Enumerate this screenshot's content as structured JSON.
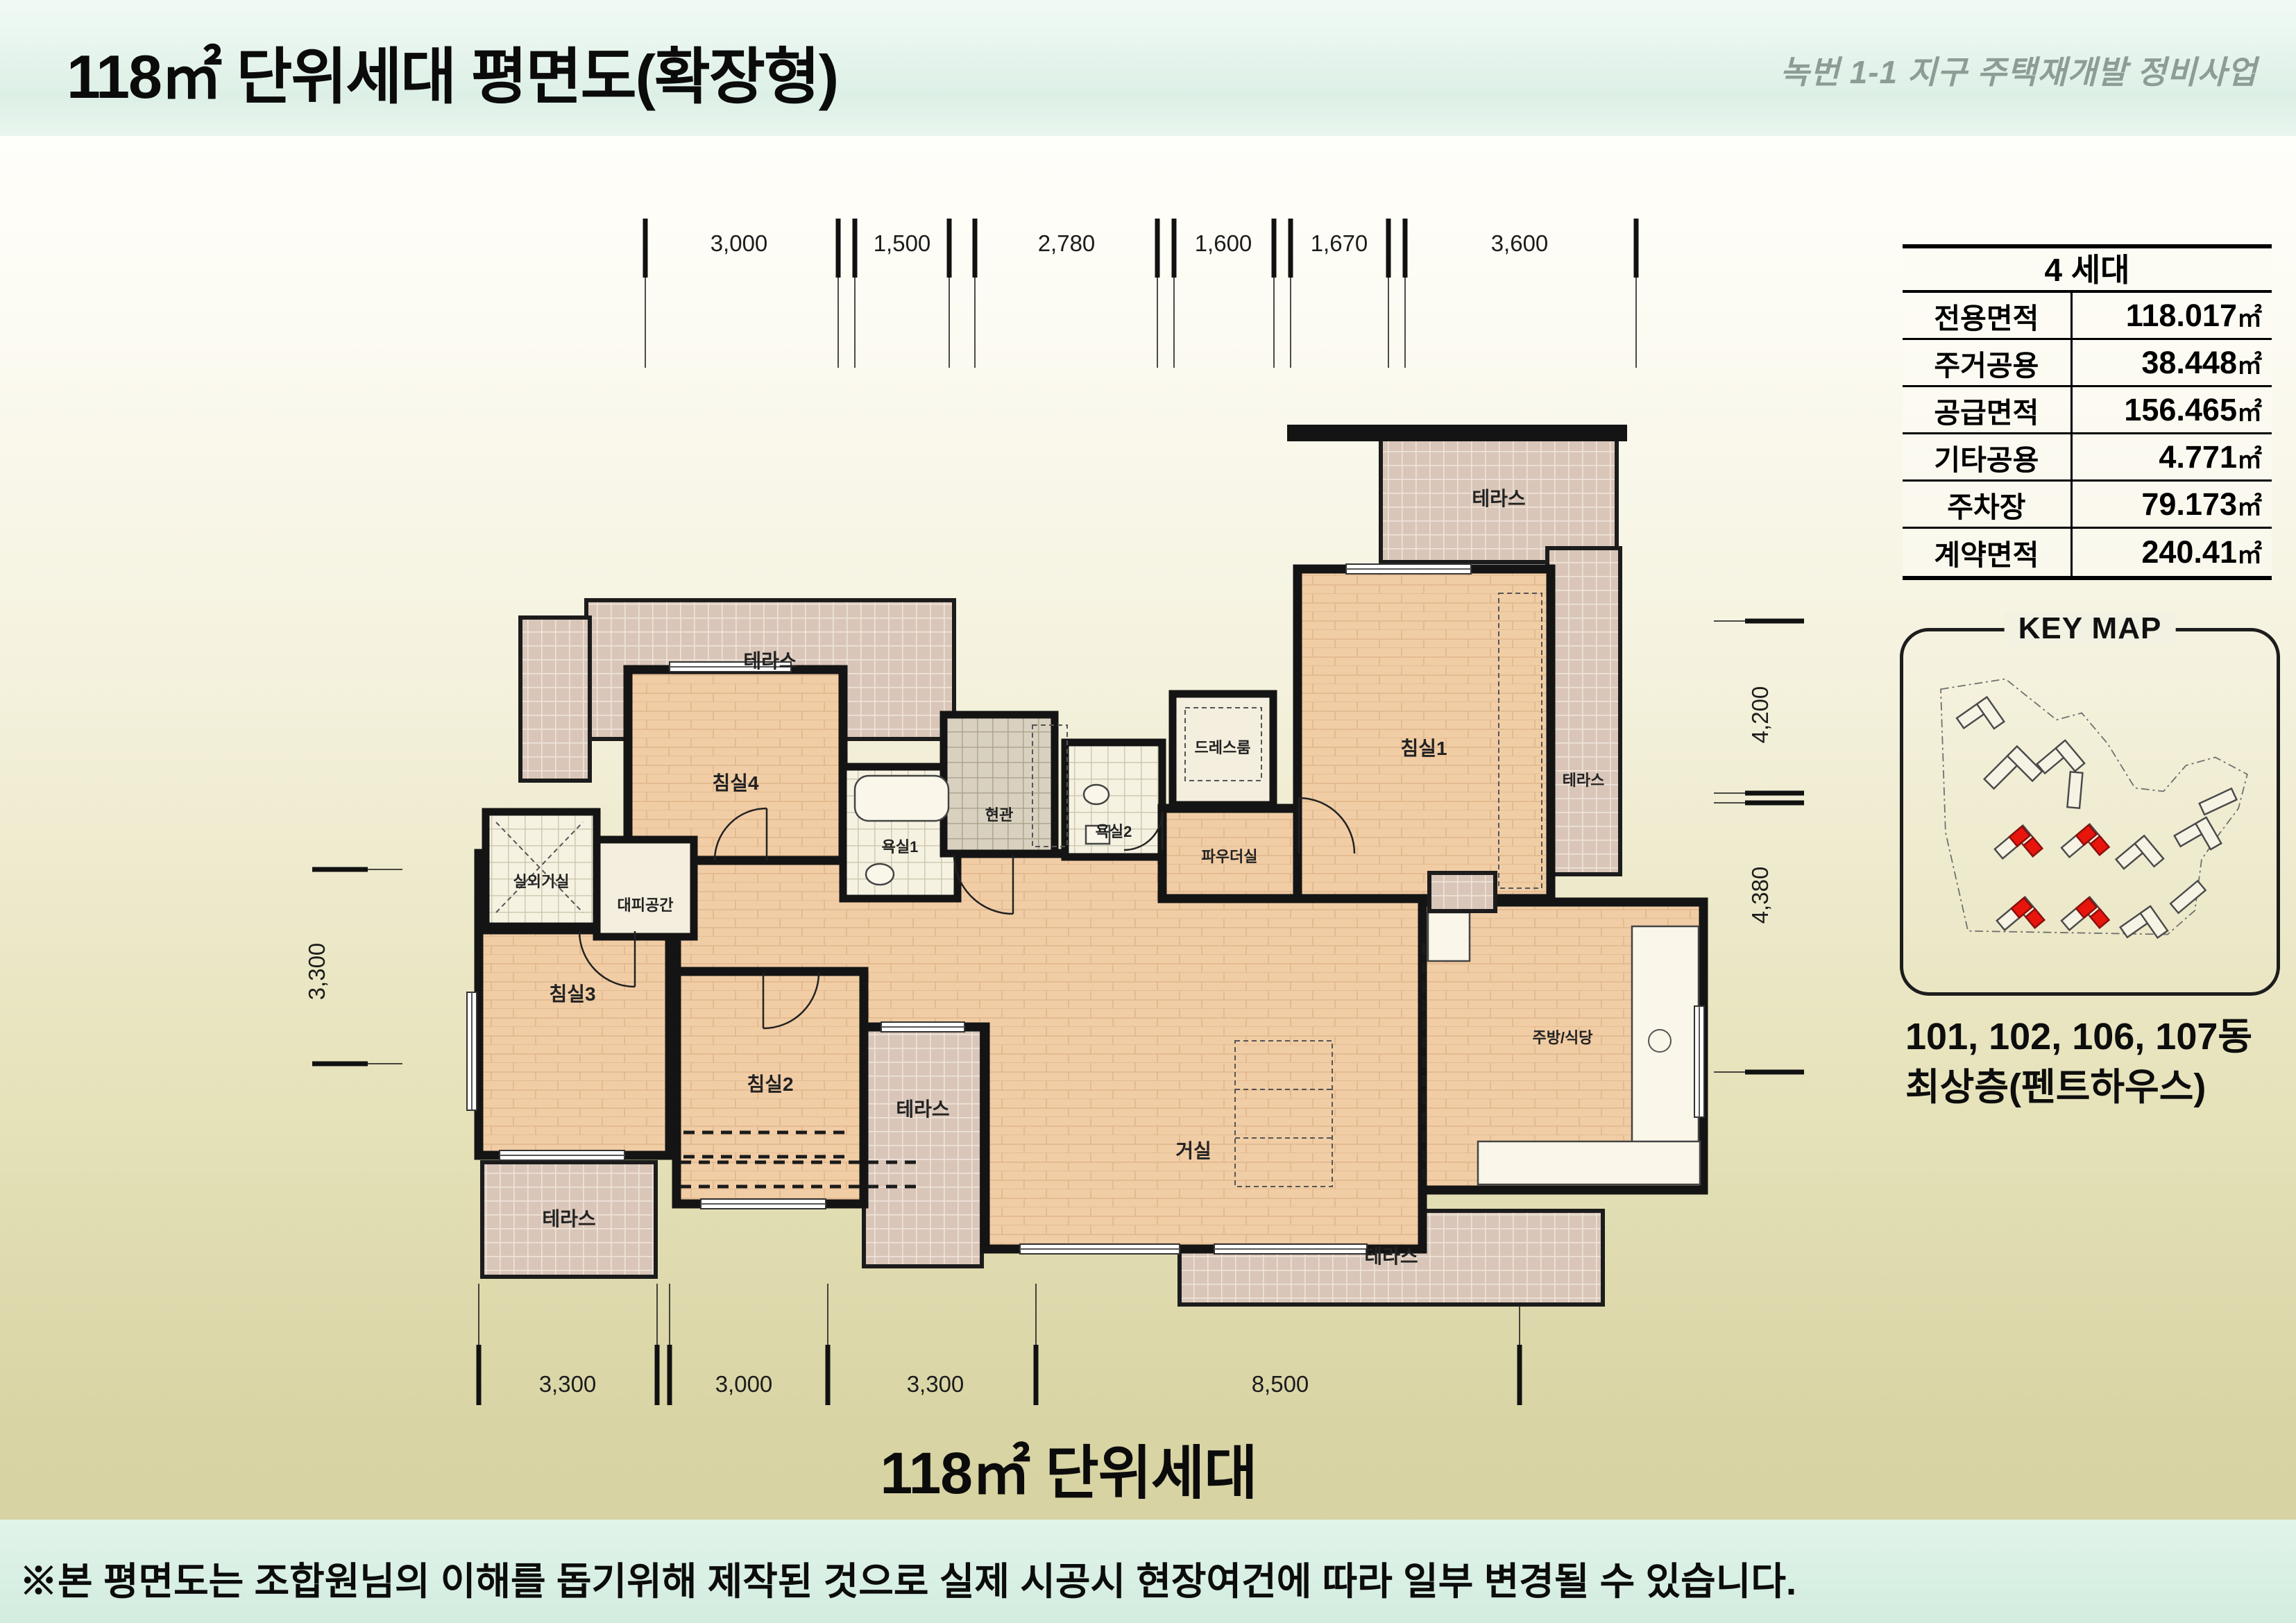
{
  "page": {
    "title": "118㎡ 단위세대 평면도(확장형)",
    "project": "녹번 1-1 지구 주택재개발 정비사업",
    "bottom_title": "118㎡ 단위세대",
    "footnote": "※본 평면도는 조합원님의 이해를 돕기위해 제작된 것으로 실제 시공시 현장여건에 따라 일부 변경될 수 있습니다."
  },
  "area_table": {
    "header": "4 세대",
    "unit": "㎡",
    "rows": [
      {
        "label": "전용면적",
        "value": "118.017"
      },
      {
        "label": "주거공용",
        "value": "38.448"
      },
      {
        "label": "공급면적",
        "value": "156.465"
      },
      {
        "label": "기타공용",
        "value": "4.771"
      },
      {
        "label": "주차장",
        "value": "79.173"
      },
      {
        "label": "계약면적",
        "value": "240.41"
      }
    ]
  },
  "key_map": {
    "title": "KEY MAP",
    "caption_line1": "101, 102, 106, 107동",
    "caption_line2": "최상층(펜트하우스)",
    "highlighted_buildings": [
      "101",
      "102",
      "106",
      "107"
    ],
    "highlight_color": "#e8150d"
  },
  "floor_plan": {
    "rooms": [
      {
        "id": "terrace-top-left",
        "label": "테라스"
      },
      {
        "id": "terrace-top-right",
        "label": "테라스"
      },
      {
        "id": "terrace-right",
        "label": "테라스"
      },
      {
        "id": "terrace-bottom-left",
        "label": "테라스"
      },
      {
        "id": "terrace-middle",
        "label": "테라스"
      },
      {
        "id": "terrace-bottom-right",
        "label": "테라스"
      },
      {
        "id": "bedroom1",
        "label": "침실1"
      },
      {
        "id": "bedroom2",
        "label": "침실2"
      },
      {
        "id": "bedroom3",
        "label": "침실3"
      },
      {
        "id": "bedroom4",
        "label": "침실4"
      },
      {
        "id": "living",
        "label": "거실"
      },
      {
        "id": "kitchen-dining",
        "label": "주방/식당"
      },
      {
        "id": "entrance",
        "label": "현관"
      },
      {
        "id": "bathroom1",
        "label": "욕실1"
      },
      {
        "id": "bathroom2",
        "label": "욕실2"
      },
      {
        "id": "dressroom",
        "label": "드레스룸"
      },
      {
        "id": "powder-room",
        "label": "파우더실"
      },
      {
        "id": "outdoor-unit-room",
        "label": "실외기실"
      },
      {
        "id": "evacuation-space",
        "label": "대피공간"
      }
    ],
    "dims_top": [
      "3,000",
      "1,500",
      "2,780",
      "1,600",
      "1,670",
      "3,600"
    ],
    "dims_bottom": [
      "3,300",
      "3,000",
      "3,300",
      "8,500"
    ],
    "dim_left": "3,300",
    "dims_right": [
      "4,200",
      "4,380"
    ]
  },
  "colors": {
    "header_bg": "#ddf0e6",
    "page_bottom": "#d5d1a0",
    "floor_wood": "#f1cda5",
    "terrace_tile": "#d9c6b8",
    "wall": "#141414",
    "accent_red": "#e8150d"
  }
}
